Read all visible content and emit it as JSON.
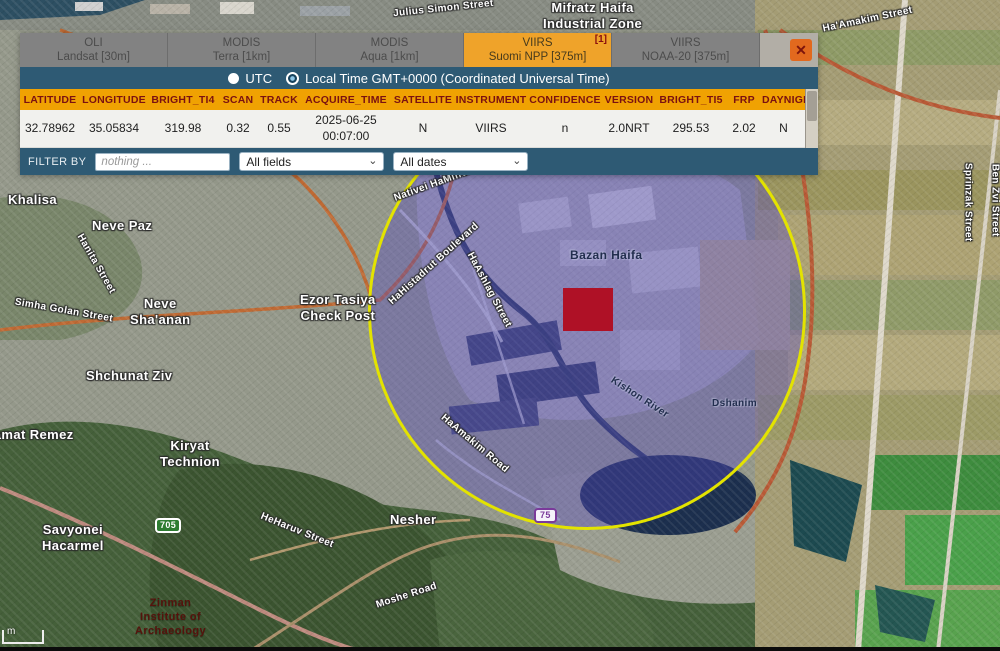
{
  "popup": {
    "close_icon": "✕",
    "tabs": [
      {
        "line1": "OLI",
        "line2": "Landsat [30m]",
        "active": false,
        "badge": ""
      },
      {
        "line1": "MODIS",
        "line2": "Terra [1km]",
        "active": false,
        "badge": ""
      },
      {
        "line1": "MODIS",
        "line2": "Aqua [1km]",
        "active": false,
        "badge": ""
      },
      {
        "line1": "VIIRS",
        "line2": "Suomi NPP [375m]",
        "active": true,
        "badge": "[1]"
      },
      {
        "line1": "VIIRS",
        "line2": "NOAA-20 [375m]",
        "active": false,
        "badge": ""
      }
    ],
    "time_toggle": [
      {
        "label": "UTC",
        "selected": false
      },
      {
        "label": "Local Time GMT+0000 (Coordinated Universal Time)",
        "selected": true
      }
    ],
    "table": {
      "columns": [
        "LATITUDE",
        "LONGITUDE",
        "BRIGHT_TI4",
        "SCAN",
        "TRACK",
        "ACQUIRE_TIME",
        "SATELLITE",
        "INSTRUMENT",
        "CONFIDENCE",
        "VERSION",
        "BRIGHT_TI5",
        "FRP",
        "DAYNIGHT"
      ],
      "rows": [
        [
          "32.78962",
          "35.05834",
          "319.98",
          "0.32",
          "0.55",
          "2025-06-25\n00:07:00",
          "N",
          "VIIRS",
          "n",
          "2.0NRT",
          "295.53",
          "2.02",
          "N"
        ]
      ]
    },
    "filter": {
      "label": "FILTER BY",
      "placeholder": "nothing ...",
      "field_select": "All fields",
      "date_select": "All dates"
    }
  },
  "icons": {
    "chevron_down": "⌄"
  },
  "map": {
    "marker_color": "#af1126",
    "circle_color": "#e3e300",
    "scale_label": "m",
    "labels": [
      {
        "name": "label-julius-simon-street",
        "text": "Julius Simon Street",
        "x": 393,
        "y": 3,
        "rot": -6,
        "cls": "sm"
      },
      {
        "name": "label-mifratz-haifa-industrial-zone",
        "text": "Mifratz Haifa\nIndustrial Zone",
        "x": 543,
        "y": 0,
        "rot": 0,
        "cls": "lg"
      },
      {
        "name": "label-haamakim-street",
        "text": "Ha'Amakim Street",
        "x": 822,
        "y": 14,
        "rot": -12,
        "cls": "sm"
      },
      {
        "name": "label-khalisa",
        "text": "Khalisa",
        "x": 8,
        "y": 192,
        "rot": 0,
        "cls": "lg"
      },
      {
        "name": "label-neve-paz",
        "text": "Neve Paz",
        "x": 92,
        "y": 218,
        "rot": 0,
        "cls": "lg"
      },
      {
        "name": "label-hanita-street",
        "text": "Hanita Street",
        "x": 62,
        "y": 258,
        "rot": 60,
        "cls": "sm"
      },
      {
        "name": "label-simha-golan-street",
        "text": "Simha Golan Street",
        "x": 14,
        "y": 305,
        "rot": 10,
        "cls": "sm"
      },
      {
        "name": "label-neve-shaanan",
        "text": "Neve\nSha'anan",
        "x": 130,
        "y": 296,
        "rot": 0,
        "cls": "lg"
      },
      {
        "name": "label-shchunat-ziv",
        "text": "Shchunat Ziv",
        "x": 86,
        "y": 368,
        "rot": 0,
        "cls": "lg"
      },
      {
        "name": "label-ezor-tasiya-check-post",
        "text": "Ezor Tasiya\nCheck Post",
        "x": 300,
        "y": 292,
        "rot": 0,
        "cls": "lg"
      },
      {
        "name": "label-ramat-remez",
        "text": "Ramat Remez",
        "x": -16,
        "y": 427,
        "rot": 0,
        "cls": "lg"
      },
      {
        "name": "label-kiryat-technion",
        "text": "Kiryat\nTechnion",
        "x": 160,
        "y": 438,
        "rot": 0,
        "cls": "lg"
      },
      {
        "name": "label-savyonei-hacarmel",
        "text": "Savyonei\nHacarmel",
        "x": 42,
        "y": 522,
        "rot": 0,
        "cls": "lg"
      },
      {
        "name": "label-heharuv-street",
        "text": "HeHaruv Street",
        "x": 258,
        "y": 525,
        "rot": 22,
        "cls": "sm"
      },
      {
        "name": "label-nesher",
        "text": "Nesher",
        "x": 390,
        "y": 512,
        "rot": 0,
        "cls": "lg"
      },
      {
        "name": "label-moshe-road",
        "text": "Moshe Road",
        "x": 375,
        "y": 590,
        "rot": -18,
        "cls": "sm"
      },
      {
        "name": "label-zinman-institute",
        "text": "Zinman\nInstitute of\nArchaeology",
        "x": 135,
        "y": 597,
        "rot": 0,
        "cls": "label-darkred"
      },
      {
        "name": "label-sprinzak-street",
        "text": "Sprinzak Street",
        "x": 928,
        "y": 196,
        "rot": 90,
        "cls": "sm"
      },
      {
        "name": "label-ben-zvi-street",
        "text": "Ben Zvi Street",
        "x": 958,
        "y": 194,
        "rot": 90,
        "cls": "sm"
      },
      {
        "name": "label-nativei-hamifratz",
        "text": "Nativei HaMifratz",
        "x": 392,
        "y": 178,
        "rot": -20,
        "cls": "sm"
      },
      {
        "name": "label-hahistadrut-boulevard",
        "text": "HaHistadrut Boulevard",
        "x": 376,
        "y": 258,
        "rot": -42,
        "cls": "sm"
      },
      {
        "name": "label-bazan-haifa",
        "text": "Bazan Haifa",
        "x": 570,
        "y": 248,
        "rot": 0,
        "cls": "label-blue"
      },
      {
        "name": "label-haashlag-street",
        "text": "HaAshlag Street",
        "x": 447,
        "y": 284,
        "rot": 62,
        "cls": "sm"
      },
      {
        "name": "label-dshanim",
        "text": "Dshanim",
        "x": 712,
        "y": 398,
        "rot": 0,
        "cls": "label-blue sm"
      },
      {
        "name": "label-kishon-river",
        "text": "Kishon River",
        "x": 606,
        "y": 392,
        "rot": 33,
        "cls": "label-blue sm"
      },
      {
        "name": "label-haamakim-road",
        "text": "HaAmakim Road",
        "x": 432,
        "y": 438,
        "rot": 40,
        "cls": "sm"
      },
      {
        "name": "road-shield-705",
        "text": "705",
        "x": 155,
        "y": 518,
        "rot": 0,
        "cls": "shield-green"
      },
      {
        "name": "road-shield-75",
        "text": "75",
        "x": 534,
        "y": 508,
        "rot": 0,
        "cls": "shield-purple"
      }
    ]
  }
}
